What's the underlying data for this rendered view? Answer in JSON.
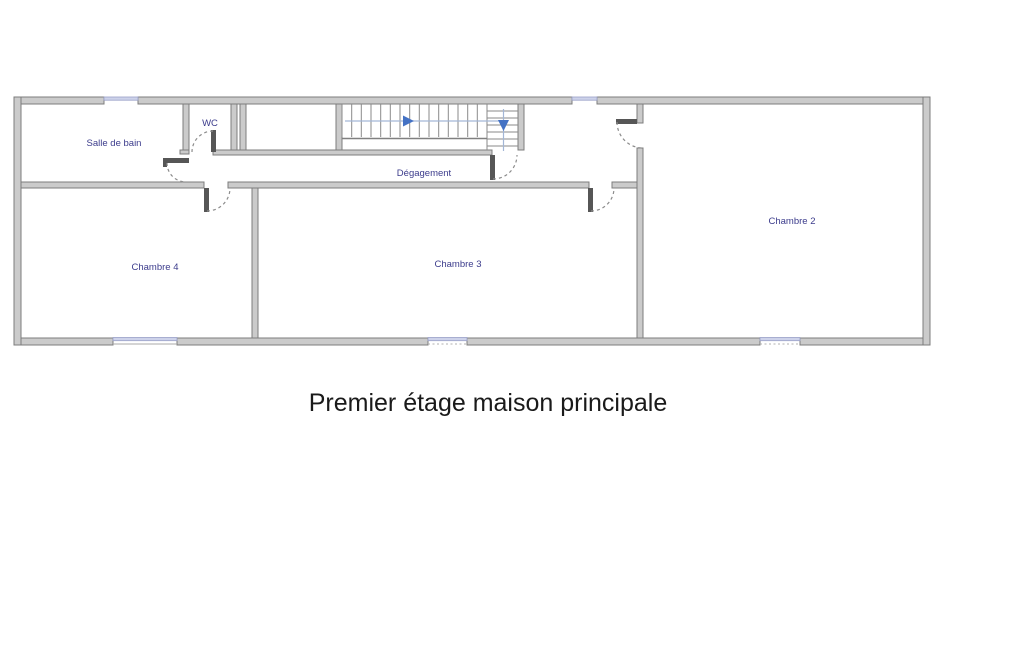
{
  "title": "Premier étage maison principale",
  "rooms": {
    "bathroom": {
      "label": "Salle de bain"
    },
    "wc": {
      "label": "WC"
    },
    "hallway": {
      "label": "Dégagement"
    },
    "bedroom4": {
      "label": "Chambre 4"
    },
    "bedroom3": {
      "label": "Chambre 3"
    },
    "bedroom2": {
      "label": "Chambre 2"
    }
  },
  "icons": {
    "stair_up_arrow": "right-pointing-triangle",
    "stair_down_arrow": "down-pointing-triangle"
  },
  "colors": {
    "wall_fill": "#cbcbcb",
    "wall_edge": "#7c7c7c",
    "room_label": "#3c3c8c",
    "title_text": "#1a1a1a",
    "window": "#cdd2ea",
    "stair_guide": "#a3b6d6",
    "stair_arrow": "#4472c4",
    "door_leaf": "#565656",
    "door_arc": "#8c8c8c"
  }
}
